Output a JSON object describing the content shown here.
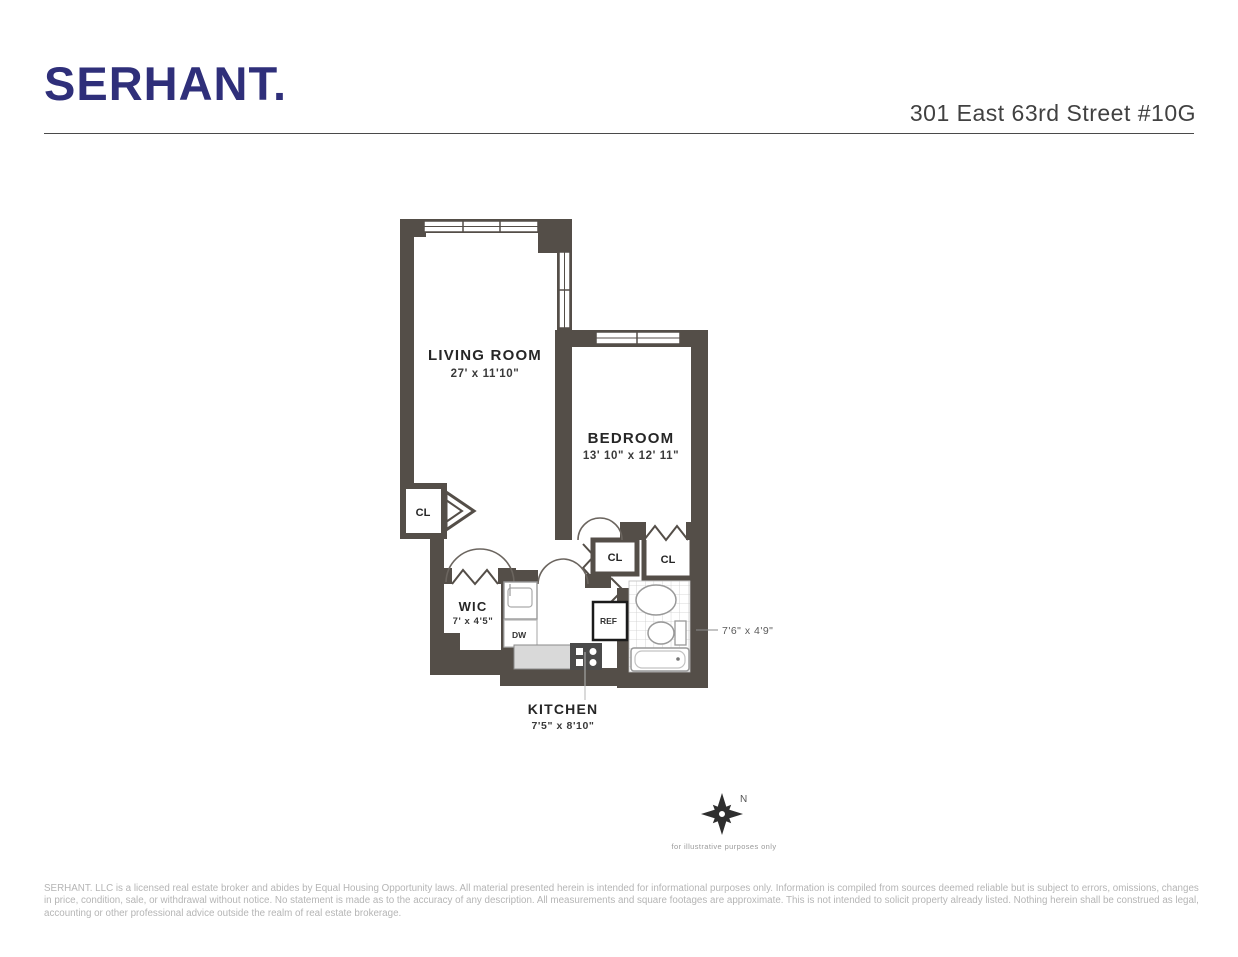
{
  "header": {
    "logo": "SERHANT.",
    "address": "301 East 63rd Street #10G"
  },
  "plan": {
    "living_room": {
      "name": "LIVING ROOM",
      "dims": "27' x 11'10\""
    },
    "bedroom": {
      "name": "BEDROOM",
      "dims": "13' 10\" x 12' 11\""
    },
    "wic": {
      "name": "WIC",
      "dims": "7' x 4'5\""
    },
    "kitchen": {
      "name": "KITCHEN",
      "dims": "7'5\" x 8'10\""
    },
    "bathroom": {
      "dims": "7'6\" x 4'9\""
    },
    "closets": [
      "CL",
      "CL",
      "CL"
    ],
    "appliances": {
      "dishwasher": "DW",
      "refrigerator": "REF"
    },
    "compass": {
      "north": "N",
      "note": "for illustrative purposes only"
    }
  },
  "footer": {
    "disclaimer": "SERHANT. LLC is a licensed real estate broker and abides by Equal Housing Opportunity laws. All material presented herein is intended for informational purposes only. Information is compiled from sources deemed reliable but is subject to errors, omissions, changes in price, condition, sale, or withdrawal without notice. No statement is made as to the accuracy of any description. All measurements and square footages are approximate. This is not intended to solicit property already listed. Nothing herein shall be construed as legal, accounting or other professional advice outside the realm of real estate brokerage."
  },
  "colors": {
    "brand_navy": "#2f2f7a",
    "wall": "#544e48",
    "counter": "#d9d9d9",
    "disclaimer_gray": "#b5b5b5"
  }
}
